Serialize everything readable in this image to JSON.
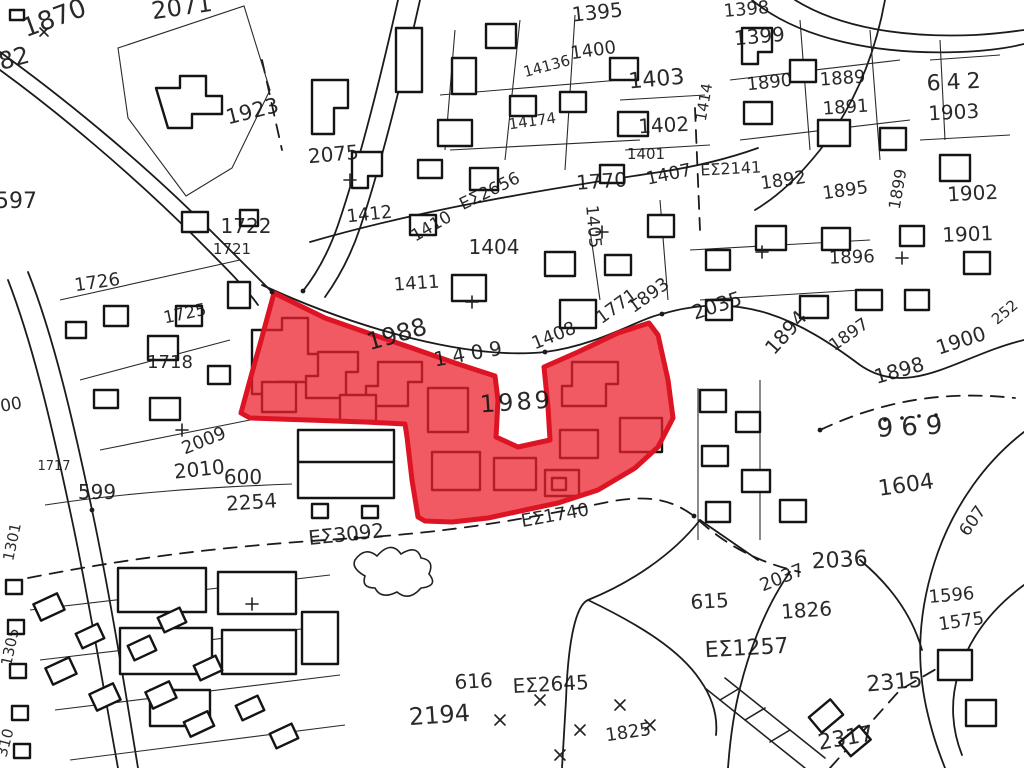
{
  "map": {
    "kind": "scanned cadastral parcel plan with red highlighted parcels",
    "background_color": "#ffffff",
    "line_color": "#1b1b1b",
    "highlight": {
      "fill_color": "#ec202c",
      "fill_opacity": 0.74,
      "stroke_color": "#dd1424",
      "stroke_width": 5,
      "label": "1989",
      "points": "274,293 325,318 368,333 412,348 455,363 495,376 498,400 496,437 518,447 550,440 548,407 544,367 578,352 618,333 649,323 658,335 668,380 673,418 658,447 635,468 598,490 558,503 525,510 488,518 452,522 425,521 418,517 412,480 407,437 405,424 365,422 308,420 250,418 241,413 250,380 262,337"
    },
    "labels": [
      {
        "text": "1870",
        "x": 57,
        "y": 26,
        "rot": -20,
        "size": 26
      },
      {
        "text": "82",
        "x": 16,
        "y": 66,
        "rot": -15,
        "size": 24
      },
      {
        "text": "2071",
        "x": 183,
        "y": 15,
        "rot": -8,
        "size": 24
      },
      {
        "text": "1923",
        "x": 254,
        "y": 118,
        "rot": -14,
        "size": 21
      },
      {
        "text": "597",
        "x": 16,
        "y": 208,
        "rot": 0,
        "size": 22
      },
      {
        "text": "1722",
        "x": 246,
        "y": 233,
        "rot": 0,
        "size": 20
      },
      {
        "text": "1721",
        "x": 232,
        "y": 254,
        "rot": 0,
        "size": 15
      },
      {
        "text": "1726",
        "x": 98,
        "y": 288,
        "rot": -8,
        "size": 18
      },
      {
        "text": "1725",
        "x": 186,
        "y": 319,
        "rot": -12,
        "size": 17
      },
      {
        "text": "1718",
        "x": 170,
        "y": 368,
        "rot": 0,
        "size": 18
      },
      {
        "text": "1717",
        "x": 54,
        "y": 470,
        "rot": 0,
        "size": 13
      },
      {
        "text": "00",
        "x": 12,
        "y": 410,
        "rot": -10,
        "size": 17
      },
      {
        "text": "2009",
        "x": 206,
        "y": 446,
        "rot": -22,
        "size": 18
      },
      {
        "text": "2010",
        "x": 200,
        "y": 476,
        "rot": -6,
        "size": 20
      },
      {
        "text": "600",
        "x": 243,
        "y": 484,
        "rot": 0,
        "size": 20
      },
      {
        "text": "599",
        "x": 97,
        "y": 499,
        "rot": 0,
        "size": 20
      },
      {
        "text": "2254",
        "x": 252,
        "y": 509,
        "rot": -4,
        "size": 20
      },
      {
        "text": "1301",
        "x": 17,
        "y": 543,
        "rot": -78,
        "size": 15
      },
      {
        "text": "1305",
        "x": 15,
        "y": 648,
        "rot": -78,
        "size": 15
      },
      {
        "text": "310",
        "x": 10,
        "y": 744,
        "rot": -75,
        "size": 15
      },
      {
        "text": "2075",
        "x": 334,
        "y": 161,
        "rot": -5,
        "size": 20
      },
      {
        "text": "ΕΣ2656",
        "x": 492,
        "y": 196,
        "rot": -26,
        "size": 17
      },
      {
        "text": "1412",
        "x": 370,
        "y": 220,
        "rot": -6,
        "size": 18
      },
      {
        "text": "1410",
        "x": 434,
        "y": 231,
        "rot": -30,
        "size": 17
      },
      {
        "text": "1411",
        "x": 417,
        "y": 289,
        "rot": -4,
        "size": 18
      },
      {
        "text": "1404",
        "x": 494,
        "y": 254,
        "rot": 0,
        "size": 20
      },
      {
        "text": "1405",
        "x": 588,
        "y": 227,
        "rot": 85,
        "size": 17
      },
      {
        "text": "1770",
        "x": 602,
        "y": 188,
        "rot": -4,
        "size": 20
      },
      {
        "text": "1407",
        "x": 670,
        "y": 180,
        "rot": -12,
        "size": 18
      },
      {
        "text": "1414",
        "x": 709,
        "y": 103,
        "rot": -80,
        "size": 15
      },
      {
        "text": "1403",
        "x": 657,
        "y": 86,
        "rot": -5,
        "size": 22
      },
      {
        "text": "1402",
        "x": 664,
        "y": 132,
        "rot": -3,
        "size": 20
      },
      {
        "text": "1401",
        "x": 646,
        "y": 159,
        "rot": 0,
        "size": 15
      },
      {
        "text": "1400",
        "x": 594,
        "y": 56,
        "rot": -8,
        "size": 18
      },
      {
        "text": "1395",
        "x": 598,
        "y": 19,
        "rot": -6,
        "size": 20
      },
      {
        "text": "14136",
        "x": 548,
        "y": 71,
        "rot": -15,
        "size": 15
      },
      {
        "text": "14174",
        "x": 533,
        "y": 126,
        "rot": -8,
        "size": 15
      },
      {
        "text": "1398",
        "x": 747,
        "y": 15,
        "rot": -5,
        "size": 18
      },
      {
        "text": "1399",
        "x": 760,
        "y": 43,
        "rot": -5,
        "size": 20
      },
      {
        "text": "1890",
        "x": 770,
        "y": 88,
        "rot": -6,
        "size": 18
      },
      {
        "text": "1889",
        "x": 843,
        "y": 84,
        "rot": -4,
        "size": 18
      },
      {
        "text": "1891",
        "x": 846,
        "y": 113,
        "rot": -4,
        "size": 18
      },
      {
        "text": "ΕΣ2141",
        "x": 731,
        "y": 174,
        "rot": -3,
        "size": 16
      },
      {
        "text": "1892",
        "x": 784,
        "y": 186,
        "rot": -8,
        "size": 18
      },
      {
        "text": "1895",
        "x": 846,
        "y": 196,
        "rot": -8,
        "size": 18
      },
      {
        "text": "1899",
        "x": 903,
        "y": 190,
        "rot": -80,
        "size": 16
      },
      {
        "text": "642",
        "x": 957,
        "y": 89,
        "rot": -3,
        "size": 22,
        "ls": 6
      },
      {
        "text": "1903",
        "x": 954,
        "y": 119,
        "rot": -3,
        "size": 20
      },
      {
        "text": "1902",
        "x": 973,
        "y": 200,
        "rot": -3,
        "size": 20
      },
      {
        "text": "1901",
        "x": 968,
        "y": 241,
        "rot": -2,
        "size": 20
      },
      {
        "text": "1896",
        "x": 852,
        "y": 263,
        "rot": -2,
        "size": 18
      },
      {
        "text": "1988",
        "x": 399,
        "y": 342,
        "rot": -16,
        "size": 24
      },
      {
        "text": "1409",
        "x": 472,
        "y": 360,
        "rot": -10,
        "size": 20,
        "ls": 6
      },
      {
        "text": "1408",
        "x": 556,
        "y": 341,
        "rot": -22,
        "size": 18
      },
      {
        "text": "1771",
        "x": 620,
        "y": 311,
        "rot": -36,
        "size": 18
      },
      {
        "text": "1893",
        "x": 652,
        "y": 300,
        "rot": -36,
        "size": 18
      },
      {
        "text": "2035",
        "x": 719,
        "y": 312,
        "rot": -18,
        "size": 20
      },
      {
        "text": "1894",
        "x": 791,
        "y": 337,
        "rot": -48,
        "size": 20
      },
      {
        "text": "1897",
        "x": 852,
        "y": 339,
        "rot": -35,
        "size": 17
      },
      {
        "text": "1898",
        "x": 901,
        "y": 377,
        "rot": -16,
        "size": 20
      },
      {
        "text": "1900",
        "x": 963,
        "y": 347,
        "rot": -18,
        "size": 20
      },
      {
        "text": "252",
        "x": 1008,
        "y": 316,
        "rot": -40,
        "size": 15
      },
      {
        "text": "969",
        "x": 914,
        "y": 435,
        "rot": -3,
        "size": 26,
        "ls": 8
      },
      {
        "text": "1604",
        "x": 907,
        "y": 492,
        "rot": -8,
        "size": 22
      },
      {
        "text": "607",
        "x": 977,
        "y": 524,
        "rot": -55,
        "size": 17
      },
      {
        "text": "1989",
        "x": 517,
        "y": 410,
        "rot": -4,
        "size": 24,
        "ls": 3
      },
      {
        "text": "ΕΣ1740",
        "x": 556,
        "y": 521,
        "rot": -10,
        "size": 18
      },
      {
        "text": "ΕΣ3092",
        "x": 347,
        "y": 541,
        "rot": -6,
        "size": 20
      },
      {
        "text": "2036",
        "x": 840,
        "y": 567,
        "rot": -3,
        "size": 22
      },
      {
        "text": "2037",
        "x": 784,
        "y": 583,
        "rot": -22,
        "size": 18
      },
      {
        "text": "615",
        "x": 710,
        "y": 608,
        "rot": -3,
        "size": 20
      },
      {
        "text": "1826",
        "x": 807,
        "y": 617,
        "rot": -4,
        "size": 20
      },
      {
        "text": "ΕΣ1257",
        "x": 747,
        "y": 655,
        "rot": -3,
        "size": 22
      },
      {
        "text": "1596",
        "x": 952,
        "y": 601,
        "rot": -5,
        "size": 18
      },
      {
        "text": "1575",
        "x": 962,
        "y": 627,
        "rot": -8,
        "size": 18
      },
      {
        "text": "616",
        "x": 474,
        "y": 688,
        "rot": -3,
        "size": 20
      },
      {
        "text": "ΕΣ2645",
        "x": 551,
        "y": 691,
        "rot": -3,
        "size": 20
      },
      {
        "text": "2194",
        "x": 440,
        "y": 723,
        "rot": -4,
        "size": 24
      },
      {
        "text": "1825",
        "x": 629,
        "y": 738,
        "rot": -8,
        "size": 18
      },
      {
        "text": "2315",
        "x": 895,
        "y": 689,
        "rot": -5,
        "size": 22
      },
      {
        "text": "2317",
        "x": 847,
        "y": 745,
        "rot": -10,
        "size": 22
      }
    ]
  }
}
